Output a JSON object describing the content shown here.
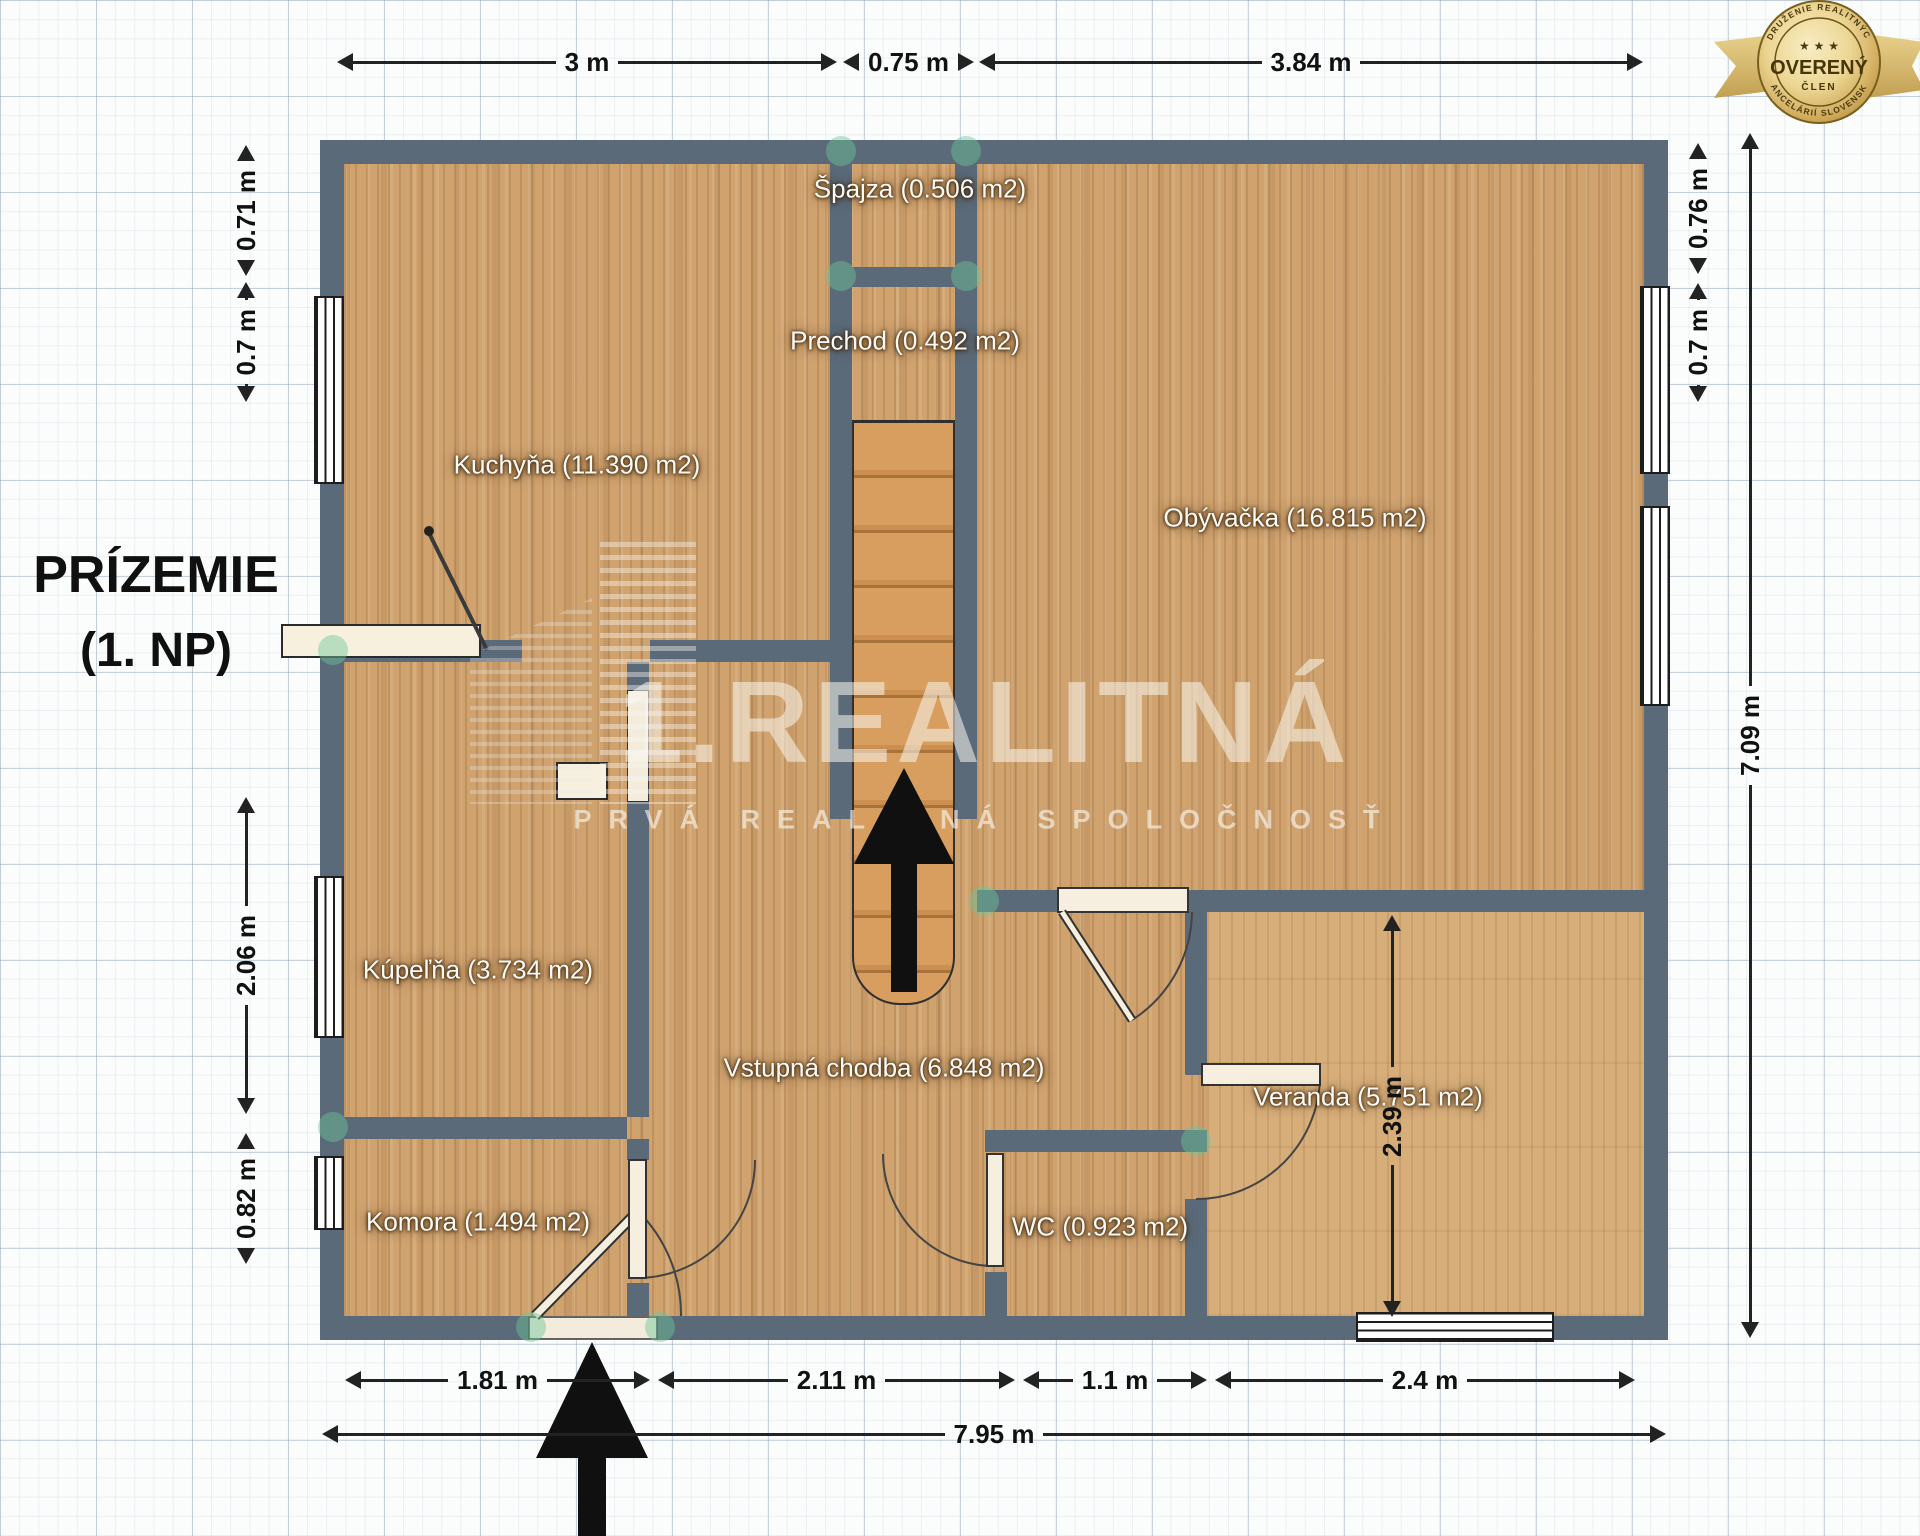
{
  "title": {
    "line1": "PRÍZEMIE",
    "line2": "(1. NP)"
  },
  "watermark": {
    "brand": "1.REALITNÁ",
    "tagline": "PRVÁ REALITNÁ SPOLOČNOSŤ"
  },
  "badge": {
    "arc_top": "ZDRUŽENIE REALITNÝCH",
    "arc_bottom": "KANCELÁRIÍ SLOVENSKA",
    "stars": "★ ★ ★",
    "title": "OVERENÝ",
    "subtitle": "ČLEN"
  },
  "rooms": [
    {
      "id": "kuchyna",
      "label": "Kuchyňa (11.390 m2)"
    },
    {
      "id": "spajza",
      "label": "Špajza (0.506 m2)"
    },
    {
      "id": "prechod",
      "label": "Prechod (0.492 m2)"
    },
    {
      "id": "obyvacka",
      "label": "Obývačka (16.815 m2)"
    },
    {
      "id": "kupelna",
      "label": "Kúpeľňa (3.734 m2)"
    },
    {
      "id": "vstupna_chodba",
      "label": "Vstupná chodba (6.848 m2)"
    },
    {
      "id": "veranda",
      "label": "Veranda (5.751 m2)"
    },
    {
      "id": "komora",
      "label": "Komora (1.494 m2)"
    },
    {
      "id": "wc",
      "label": "WC (0.923 m2)"
    }
  ],
  "dimensions": {
    "top": [
      "3 m",
      "0.75 m",
      "3.84 m"
    ],
    "bottom": [
      "1.81 m",
      "2.11 m",
      "1.1 m",
      "2.4 m",
      "7.95 m"
    ],
    "left": [
      "0.71 m",
      "0.7 m",
      "2.06 m",
      "0.82 m"
    ],
    "right": [
      "0.76 m",
      "0.7 m",
      "7.09 m",
      "2.39 m"
    ]
  },
  "colors": {
    "wall": "#5b6a79",
    "floor": "#cfa26e",
    "stairs": "#d89e60",
    "junction_accent": "#6dc69a",
    "badge_gold": "#d9b961",
    "dimension_text": "#111111"
  }
}
